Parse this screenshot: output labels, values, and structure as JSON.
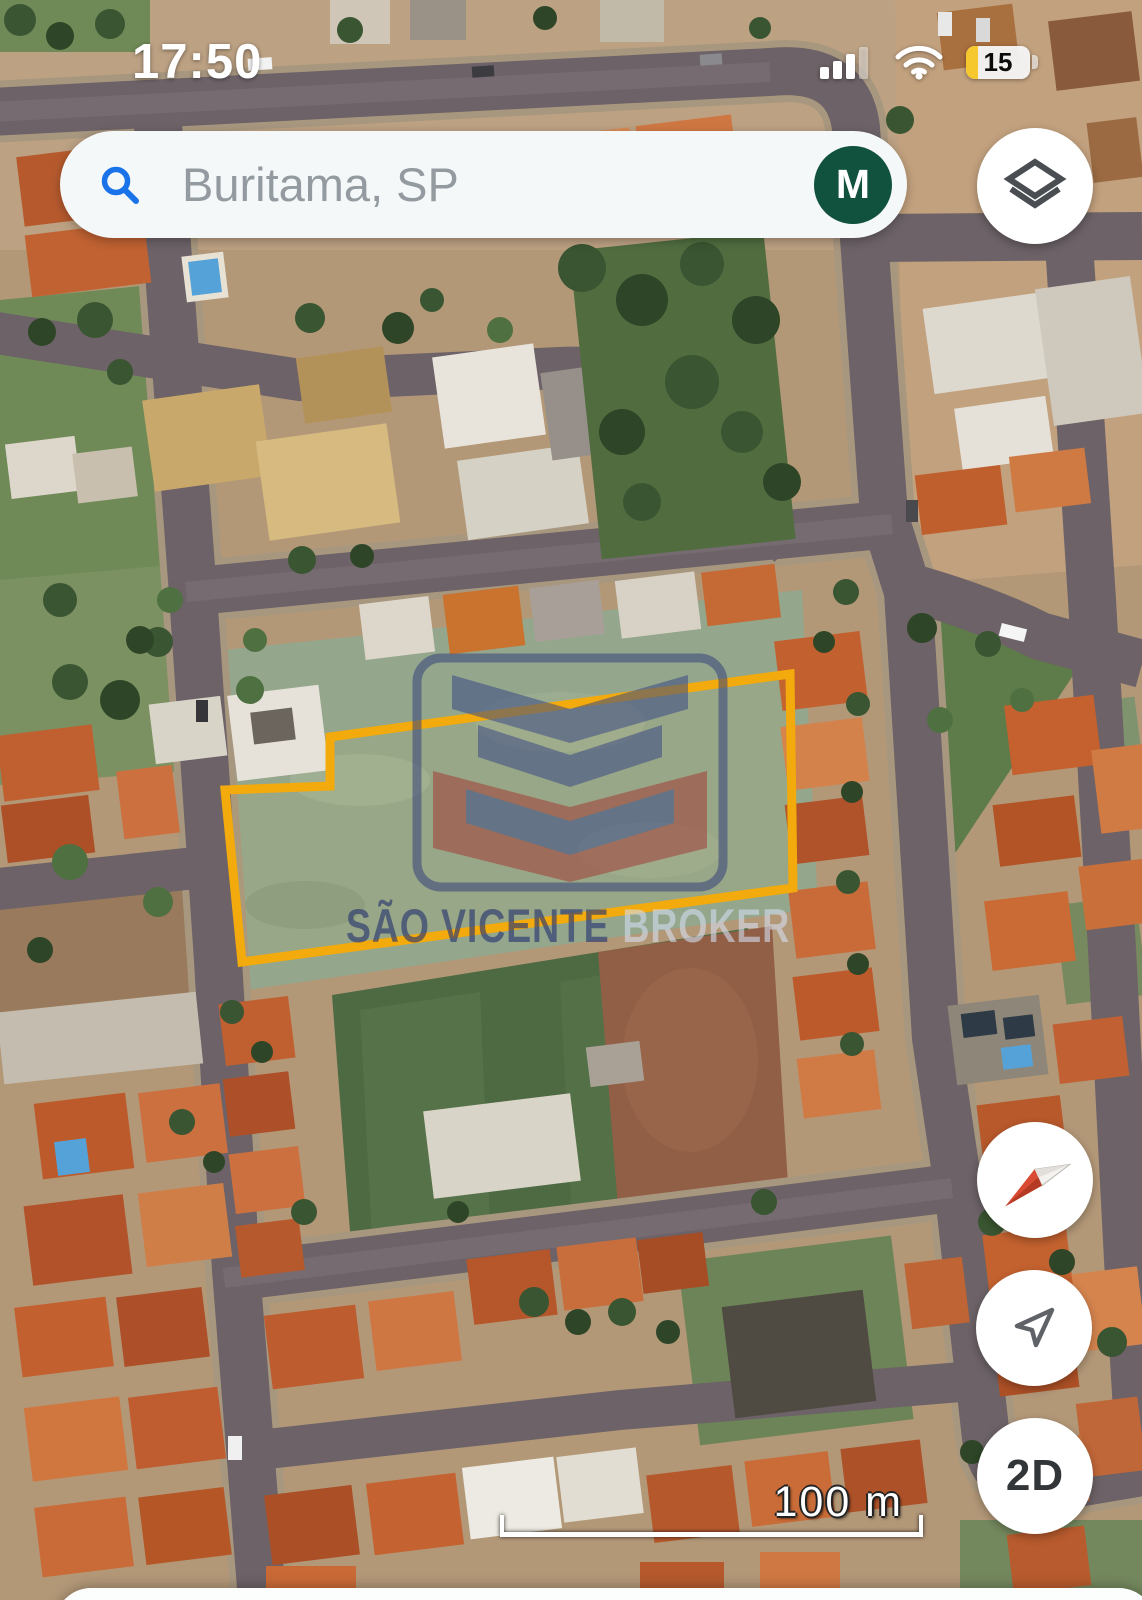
{
  "app": {
    "name": "Google Maps",
    "view_mode": "satellite-3d"
  },
  "status_bar": {
    "time": "17:50",
    "battery_percent": "15",
    "signal_icon": "cellular-signal-bars",
    "wifi_icon": "wifi",
    "battery_icon": "battery-low-yellow"
  },
  "search_bar": {
    "query": "Buritama, SP",
    "search_icon": "magnifier",
    "account_avatar_letter": "M",
    "avatar_color": "#11523F"
  },
  "map_controls": {
    "layers_button_icon": "map-layers",
    "compass_button_icon": "compass-needle",
    "my_location_button_icon": "navigation-arrow",
    "view_toggle_label": "2D"
  },
  "watermark": {
    "primary": "SÃO VICENTE",
    "secondary": "BROKER"
  },
  "scale_bar": {
    "label": "100 m"
  },
  "map": {
    "location": "Buritama, SP",
    "imagery": "satellite",
    "property_outline_color": "#F2AA0C",
    "road_color": "#6C6267",
    "grass_lot_color": "#94A68C",
    "roof_color": "#C2602F"
  }
}
